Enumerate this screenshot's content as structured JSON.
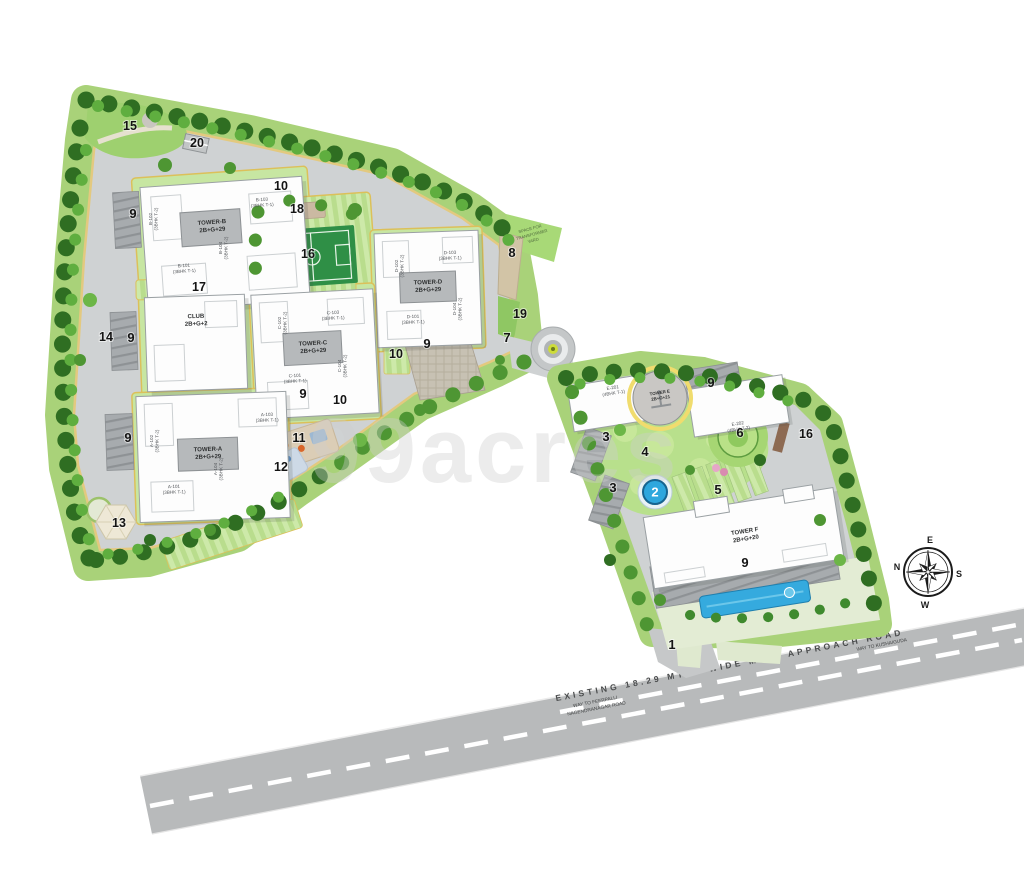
{
  "site": {
    "watermark": "99acres",
    "compass": {
      "top": "E",
      "left": "N",
      "right": "S",
      "bottom": "W"
    },
    "road_labels": {
      "main": "EXISTING 18.29 MTRS WIDE MAIN APPROACH ROAD",
      "left_line1": "WAY TO FEERPALLI",
      "left_line2": "NAGENDRANAGAR ROAD",
      "right": "WAY TO KUSHAIGUDA"
    },
    "transformer_yard": {
      "line1": "SPACE FOR",
      "line2": "TRANSFORMER",
      "line3": "YARD"
    }
  },
  "buildings": [
    {
      "id": "tower-b",
      "line1": "TOWER-B",
      "line2": "2B+G+29",
      "cx": 212,
      "cy": 224,
      "rot": -4,
      "units": [
        {
          "t1": "B-103",
          "t2": "(3BHK T-1)",
          "x": 262,
          "y": 201,
          "rot": -4
        },
        {
          "t1": "B-102",
          "t2": "(3BHK T-2)",
          "x": 152,
          "y": 219,
          "rot": -90
        },
        {
          "t1": "B-101",
          "t2": "(3BHK T-1)",
          "x": 184,
          "y": 267,
          "rot": -4
        },
        {
          "t1": "B-104",
          "t2": "(3BHK T-2)",
          "x": 222,
          "y": 248,
          "rot": -90
        }
      ]
    },
    {
      "id": "tower-d",
      "line1": "TOWER-D",
      "line2": "2B+G+29",
      "cx": 428,
      "cy": 284,
      "rot": -2,
      "units": [
        {
          "t1": "D-103",
          "t2": "(3BHK T-1)",
          "x": 450,
          "y": 254,
          "rot": -2
        },
        {
          "t1": "D-102",
          "t2": "(3BHK T-2)",
          "x": 398,
          "y": 266,
          "rot": -90
        },
        {
          "t1": "D-101",
          "t2": "(3BHK T-1)",
          "x": 413,
          "y": 318,
          "rot": -2
        },
        {
          "t1": "D-104",
          "t2": "(3BHK T-2)",
          "x": 456,
          "y": 309,
          "rot": -90
        }
      ]
    },
    {
      "id": "tower-c",
      "line1": "TOWER-C",
      "line2": "2B+G+29",
      "cx": 313,
      "cy": 345,
      "rot": -3,
      "units": [
        {
          "t1": "C-103",
          "t2": "(3BHK T-1)",
          "x": 333,
          "y": 314,
          "rot": -3
        },
        {
          "t1": "C-102",
          "t2": "(3BHK T-2)",
          "x": 281,
          "y": 323,
          "rot": -90
        },
        {
          "t1": "C-101",
          "t2": "(3BHK T-1)",
          "x": 295,
          "y": 377,
          "rot": -3
        },
        {
          "t1": "C-104",
          "t2": "(3BHK T-2)",
          "x": 341,
          "y": 366,
          "rot": -90
        }
      ]
    },
    {
      "id": "tower-a",
      "line1": "TOWER-A",
      "line2": "2B+G+29",
      "cx": 208,
      "cy": 451,
      "rot": -2,
      "units": [
        {
          "t1": "A-103",
          "t2": "(3BHK T-1)",
          "x": 267,
          "y": 416,
          "rot": -2
        },
        {
          "t1": "A-102",
          "t2": "(3BHK T-2)",
          "x": 153,
          "y": 441,
          "rot": -90
        },
        {
          "t1": "A-101",
          "t2": "(3BHK T-1)",
          "x": 174,
          "y": 488,
          "rot": -2
        },
        {
          "t1": "A-104",
          "t2": "(3BHK T-2)",
          "x": 217,
          "y": 469,
          "rot": -90
        }
      ]
    },
    {
      "id": "club",
      "line1": "CLUB",
      "line2": "2B+G+2",
      "cx": 196,
      "cy": 318,
      "rot": -2,
      "units": []
    },
    {
      "id": "tower-e",
      "line1": "TOWER E",
      "line2": "2B+G+21",
      "cx": 660,
      "cy": 394,
      "rot": -9,
      "units": [
        {
          "t1": "E-201",
          "t2": "(4BHK T-1)",
          "x": 613,
          "y": 389,
          "rot": -9
        },
        {
          "t1": "E-202",
          "t2": "(4BHK T-2)",
          "x": 738,
          "y": 425,
          "rot": -9
        }
      ]
    },
    {
      "id": "tower-f",
      "line1": "TOWER F",
      "line2": "2B+G+20",
      "cx": 745,
      "cy": 533,
      "rot": -9,
      "units": []
    }
  ],
  "markers": [
    {
      "label": "1",
      "x": 672,
      "y": 649
    },
    {
      "label": "2",
      "x": 655,
      "y": 492,
      "style": "badge"
    },
    {
      "label": "3",
      "x": 606,
      "y": 441
    },
    {
      "label": "3",
      "x": 613,
      "y": 492
    },
    {
      "label": "4",
      "x": 645,
      "y": 456
    },
    {
      "label": "5",
      "x": 718,
      "y": 494
    },
    {
      "label": "6",
      "x": 740,
      "y": 437
    },
    {
      "label": "7",
      "x": 507,
      "y": 342
    },
    {
      "label": "8",
      "x": 512,
      "y": 257
    },
    {
      "label": "9",
      "x": 133,
      "y": 218
    },
    {
      "label": "9",
      "x": 131,
      "y": 342
    },
    {
      "label": "9",
      "x": 128,
      "y": 442
    },
    {
      "label": "9",
      "x": 427,
      "y": 348
    },
    {
      "label": "9",
      "x": 303,
      "y": 398
    },
    {
      "label": "9",
      "x": 711,
      "y": 387
    },
    {
      "label": "9",
      "x": 745,
      "y": 567
    },
    {
      "label": "10",
      "x": 281,
      "y": 190
    },
    {
      "label": "10",
      "x": 396,
      "y": 358
    },
    {
      "label": "10",
      "x": 340,
      "y": 404
    },
    {
      "label": "11",
      "x": 299,
      "y": 442
    },
    {
      "label": "12",
      "x": 281,
      "y": 471
    },
    {
      "label": "13",
      "x": 119,
      "y": 527
    },
    {
      "label": "14",
      "x": 106,
      "y": 341
    },
    {
      "label": "15",
      "x": 130,
      "y": 130
    },
    {
      "label": "16",
      "x": 308,
      "y": 258
    },
    {
      "label": "16",
      "x": 806,
      "y": 438
    },
    {
      "label": "17",
      "x": 199,
      "y": 291
    },
    {
      "label": "18",
      "x": 297,
      "y": 213
    },
    {
      "label": "19",
      "x": 520,
      "y": 318
    },
    {
      "label": "20",
      "x": 197,
      "y": 147
    }
  ],
  "colors": {
    "road_main": "#b8babb",
    "road_inner": "#cfd2d3",
    "belt_green": "#a9d279",
    "tree_dark": "#2f6e22",
    "tree_light": "#5fae3f",
    "plot_border": "#dcc05a",
    "lawn": "#c7e6a2",
    "court_green": "#2f8f46",
    "pool_blue": "#2ea7dd",
    "building_white": "#fdfdfd",
    "core_gray": "#b6b9bb"
  }
}
